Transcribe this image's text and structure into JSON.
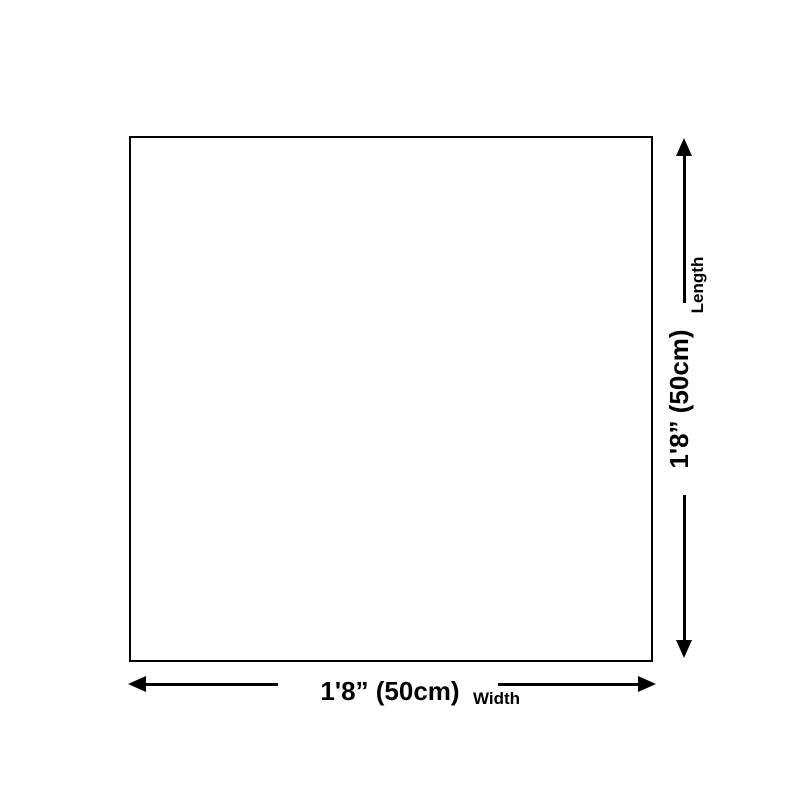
{
  "colors": {
    "foreground": "#000000",
    "background": "#ffffff"
  },
  "diagram": {
    "shape": "square-outline",
    "length_dimension": {
      "value": "1'8” (50cm)",
      "label": "Length"
    },
    "width_dimension": {
      "value": "1'8” (50cm)",
      "label": "Width"
    },
    "icons": {
      "up_arrow": "arrow-up",
      "down_arrow": "arrow-down",
      "left_arrow": "arrow-left",
      "right_arrow": "arrow-right"
    }
  }
}
